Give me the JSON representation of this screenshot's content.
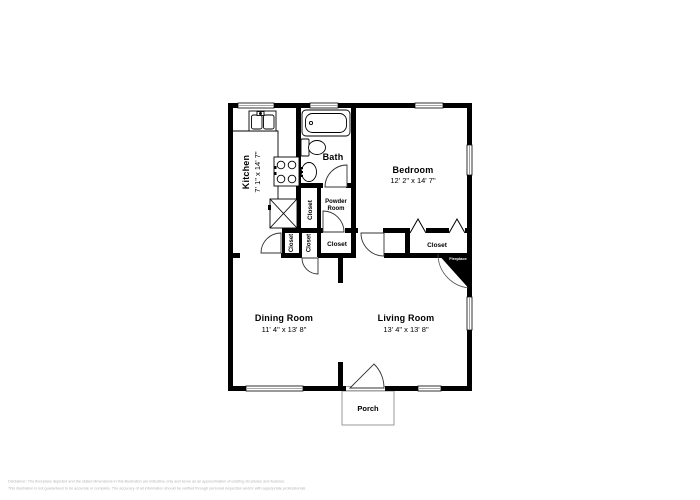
{
  "plan": {
    "rooms": {
      "kitchen": {
        "name": "Kitchen",
        "dims": "7' 1\" x 14' 7\""
      },
      "bath": {
        "name": "Bath"
      },
      "bedroom": {
        "name": "Bedroom",
        "dims": "12' 2\" x 14' 7\""
      },
      "powder_room": {
        "line1": "Powder",
        "line2": "Room"
      },
      "dining_room": {
        "name": "Dining Room",
        "dims": "11' 4\" x 13' 8\""
      },
      "living_room": {
        "name": "Living Room",
        "dims": "13' 4\" x 13' 8\""
      },
      "porch": {
        "name": "Porch"
      }
    },
    "closets": {
      "hall_closet": {
        "label": "Closet"
      },
      "small_closet_1": {
        "label": "Closet"
      },
      "small_closet_2": {
        "label": "Closet"
      },
      "hallway_closet": {
        "label": "Closet"
      },
      "bedroom_closet": {
        "label": "Closet"
      }
    },
    "fireplace": {
      "label": "Fireplace"
    },
    "colors": {
      "wall": "#000000",
      "window_line": "#8a8a8a",
      "porch_outline": "#9a9a9a",
      "fireplace_fill": "#000000",
      "fireplace_text": "#ffffff",
      "disclaimer_text": "#b3b3b3"
    }
  },
  "disclaimer": {
    "line1": "Disclaimer: The floorplans depicted and the stated dimensions in this illustration are indicative only and serve as an approximation of existing structures and features.",
    "line2": "This illustration is not guaranteed to be accurate or complete. The accuracy of all information should be verified through personal inspection and/or with appropriate professionals."
  }
}
